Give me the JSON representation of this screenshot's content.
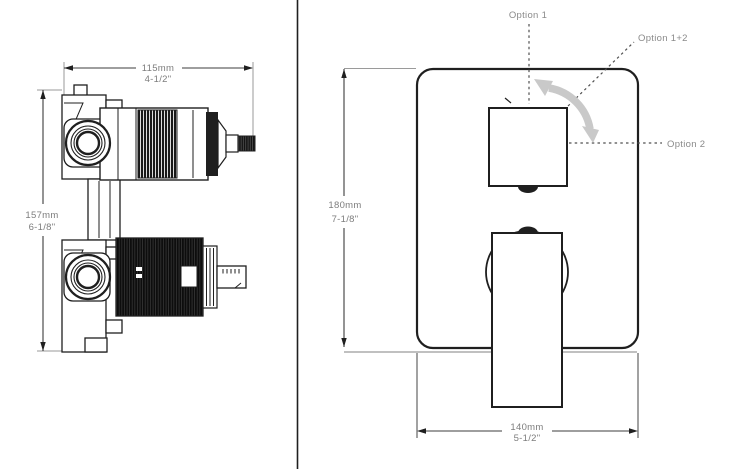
{
  "colors": {
    "line": "#1f1f1f",
    "dim_text": "#7d7d7d",
    "option_text": "#8a8a8a",
    "ext_line": "#9a9a9a",
    "dashed_line": "#4f4f4f",
    "rotate_arrow": "#c9c9c9"
  },
  "left_view": {
    "width_dim": {
      "mm": "115mm",
      "inch": "4-1/2\""
    },
    "height_dim": {
      "mm": "157mm",
      "inch": "6-1/8\""
    }
  },
  "right_view": {
    "height_dim": {
      "mm": "180mm",
      "inch": "7-1/8\""
    },
    "width_dim": {
      "mm": "140mm",
      "inch": "5-1/2\""
    },
    "option_labels": {
      "option1": "Option 1",
      "option1_2": "Option 1+2",
      "option2": "Option 2"
    }
  }
}
